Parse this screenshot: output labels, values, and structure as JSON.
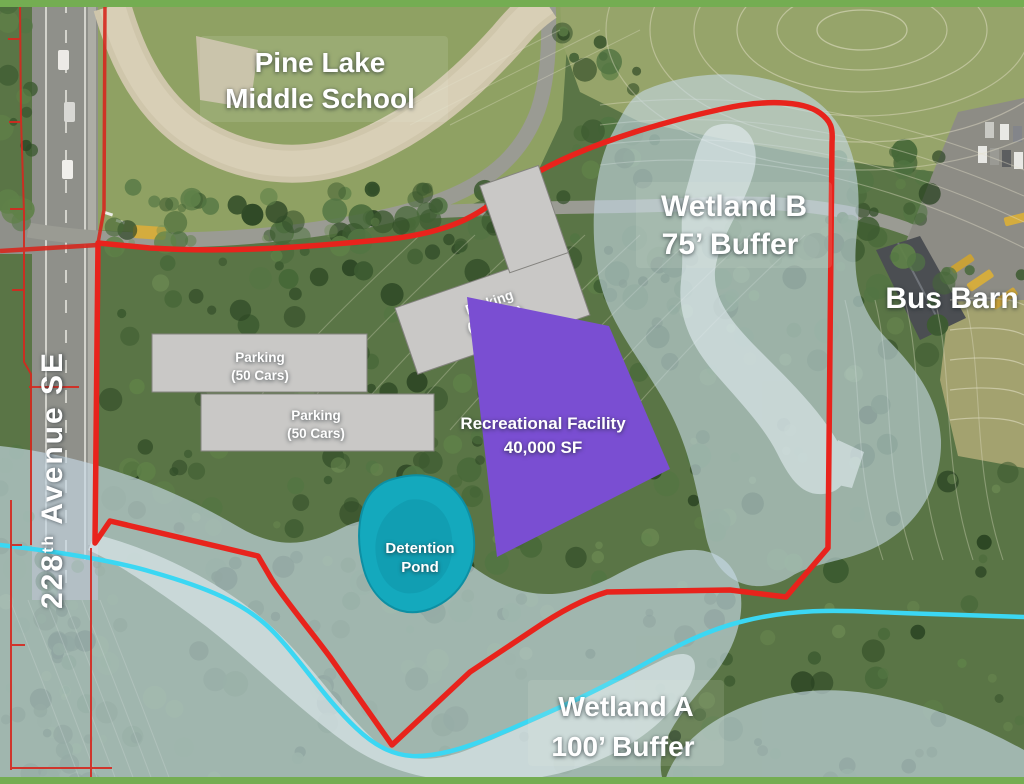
{
  "map": {
    "school": {
      "line1": "Pine Lake",
      "line2": "Middle School"
    },
    "street": {
      "number": "228",
      "superscript": "th",
      "rest": " Avenue SE"
    },
    "wetland_b": {
      "line1": "Wetland B",
      "line2": "75’ Buffer"
    },
    "wetland_a": {
      "line1": "Wetland A",
      "line2": "100’ Buffer"
    },
    "bus_barn": "Bus Barn",
    "detention_pond": {
      "line1": "Detention",
      "line2": "Pond"
    },
    "facility": {
      "line1": "Recreational Facility",
      "line2": "40,000 SF"
    },
    "parking_upper": {
      "line1": "Parking",
      "line2": "(50 Cars)"
    },
    "parking_lower": {
      "line1": "Parking",
      "line2": "(50 Cars)"
    },
    "parking_angled": {
      "line1": "Parking",
      "line2": "(50 Cars)"
    },
    "colors": {
      "boundary": "#e8231c",
      "parcel_line": "#d6281f",
      "stream": "#3bd7f3",
      "wetland_buffer": "#c5d8e3",
      "wetland_inner": "#e4eef3",
      "pond": "#14a9bd",
      "facility": "#7a4ed2"
    }
  }
}
